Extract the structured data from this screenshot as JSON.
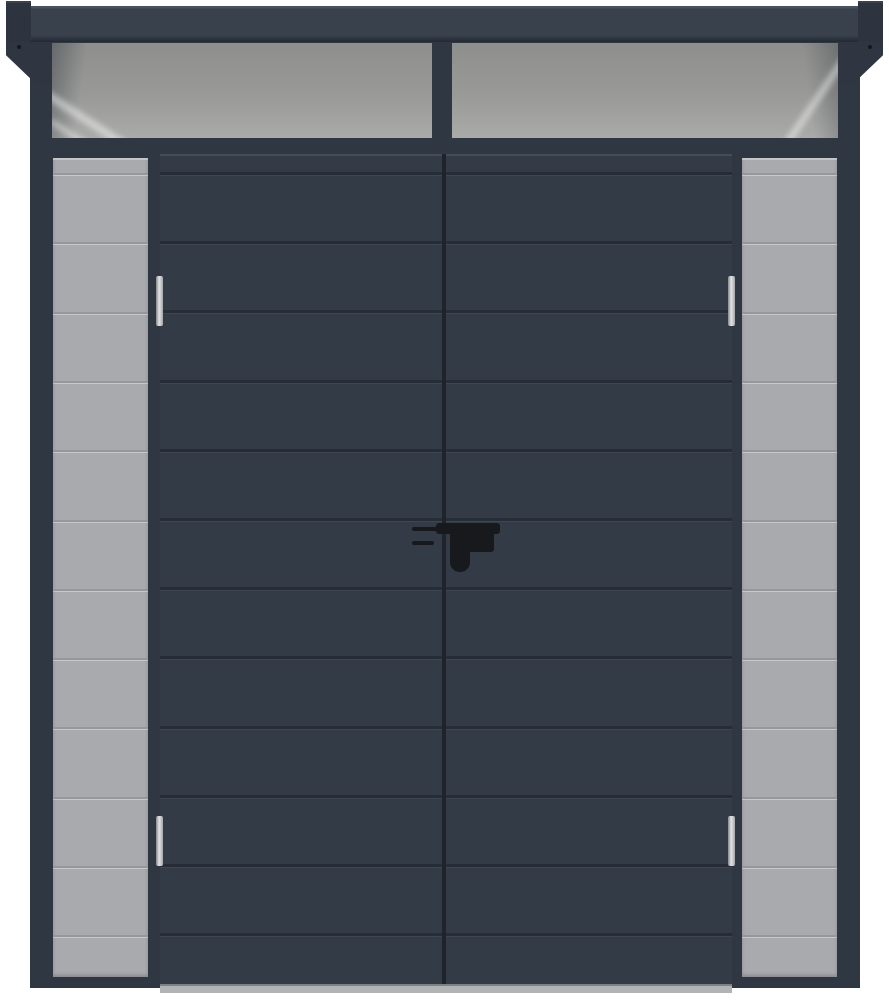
{
  "scene": {
    "type": "product-photo",
    "subject": "Anthracite pent-roof garden shed with double doors, light gray side wall panels, roof overhang brackets and two transom roof-light panels",
    "background": "#ffffff"
  },
  "structure": {
    "transom_windows": 2,
    "doors": 2,
    "door_grooves": 12,
    "door_planks": 13,
    "side_panels": 2,
    "side_panel_lines": 12,
    "hinges": 4,
    "handle_count": 1
  },
  "colors": {
    "background": "#ffffff",
    "fascia": "#39414d",
    "fascia_hi": "#4a525e",
    "fascia_lo": "#232931",
    "cap": "#2d343f",
    "bracket": "#2f3641",
    "wall": "#2f3743",
    "door": "#333b47",
    "door_hi": "#444c58",
    "groove": "#272d37",
    "gap": "#1f242c",
    "glass_top": "#8e8f8d",
    "glass_mid": "#999a98",
    "glass_bot": "#aaaba9",
    "panel": "#a9aaae",
    "panel_line": "#96979b",
    "hinge": "#c6c8ca",
    "handle": "#17191d",
    "sill": "#b2b3b5"
  }
}
